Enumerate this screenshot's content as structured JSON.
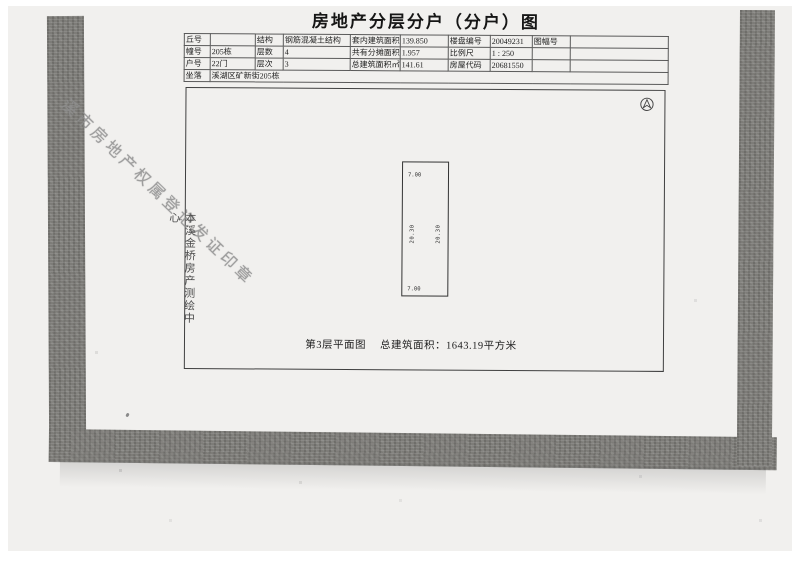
{
  "page": {
    "title": "房地产分层分户（分户）图"
  },
  "table": {
    "rows": [
      {
        "cells": [
          "丘号",
          "",
          "结构",
          "钢筋混凝土结构",
          "套内建筑面积㎡",
          "139.850",
          "楼盘编号",
          "20049231",
          "图幅号",
          ""
        ]
      },
      {
        "cells": [
          "幢号",
          "205栋",
          "层数",
          "4",
          "共有分摊面积㎡",
          "1.957",
          "比例尺",
          "1 : 250",
          "",
          ""
        ]
      },
      {
        "cells": [
          "户号",
          "22门",
          "层次",
          "3",
          "总建筑面积㎡",
          "141.61",
          "房屋代码",
          "20681550",
          "",
          ""
        ]
      }
    ],
    "location_label": "坐落",
    "location_value": "溪湖区矿新街205栋"
  },
  "plan": {
    "north_icon": "north-arrow",
    "unit": {
      "top_dim": "7.00",
      "bottom_dim": "7.00",
      "left_dim": "20.30",
      "right_dim": "20.30"
    },
    "caption": {
      "floor": "第3层平面图",
      "area": "总建筑面积：1643.19平方米"
    }
  },
  "watermarks": {
    "surveyor_vertical": "本溪金桥房产测绘中心",
    "registration_stamp_diagonal": "溪市房地产权属登记发证印章"
  },
  "colors": {
    "paper": "#f1f0ee",
    "edge_band": "#7d7c78",
    "ink": "#1f1f1f",
    "stamp_gray": "#8f8f8f"
  }
}
